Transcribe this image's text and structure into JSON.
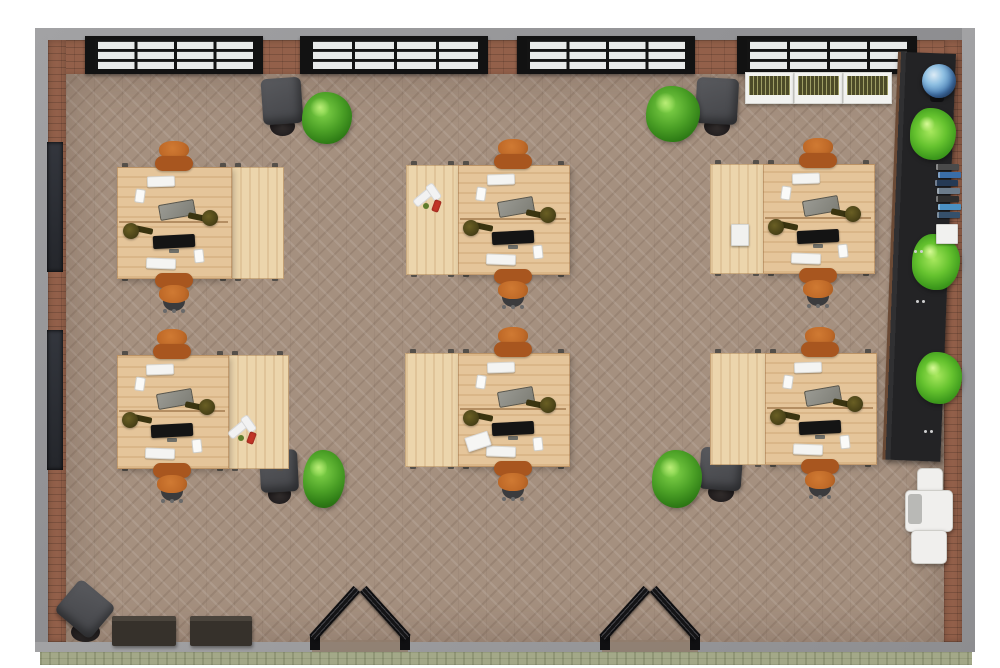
{
  "meta": {
    "description": "3D top-down floor plan render of an open-plan office with six 4-person desk clusters",
    "visible_text": []
  },
  "palette": {
    "background": "#ffffff",
    "wall_outer_grey": "#96969a",
    "brick_wall": "#93604a",
    "floor_taupe": "#a5907f",
    "window_frame_black": "#121212",
    "window_glass": "#e8eae9",
    "desk_wood": "#e5c59a",
    "desk_wood_light": "#ecd5ac",
    "chair_orange": "#c06a28",
    "chair_orange_dark": "#a8561f",
    "chair_dark_grey": "#4b4c4e",
    "plant_green": "#4ba026",
    "plant_lime": "#66c32f",
    "console_black": "#29292b",
    "lamp_olive": "#4c4418",
    "monitor_black": "#141414",
    "walkway_stone": "#a3a888",
    "planter_white": "#f2f2f0",
    "grass_olive": "#4c4a28",
    "globe_blue": "#4a7fb5",
    "cooler_white": "#f0efed",
    "bench_dark_brown": "#36312b",
    "door_black": "#1a1a1c"
  },
  "room": {
    "top_grey": [
      35,
      28,
      940,
      12
    ],
    "top_brick": [
      35,
      40,
      940,
      36
    ],
    "left_grey": [
      35,
      28,
      13,
      624
    ],
    "left_brick": [
      48,
      40,
      18,
      602
    ],
    "right_brick": [
      944,
      40,
      18,
      602
    ],
    "right_grey": [
      962,
      28,
      13,
      624
    ],
    "floor": [
      66,
      74,
      878,
      568
    ],
    "bottom_grey": [
      35,
      642,
      940,
      10
    ],
    "bottom_stone": [
      40,
      652,
      932,
      13
    ],
    "windows": [
      [
        85,
        36,
        178,
        38
      ],
      [
        300,
        36,
        188,
        38
      ],
      [
        517,
        36,
        178,
        38
      ],
      [
        737,
        36,
        180,
        38
      ]
    ],
    "window_grid": {
      "cols": 4,
      "rows": 3
    },
    "left_wall_panels": [
      [
        47,
        142,
        16,
        130
      ],
      [
        47,
        330,
        16,
        140
      ]
    ],
    "door_openings": [
      {
        "x1": 312,
        "x2": 408
      },
      {
        "x1": 602,
        "x2": 698
      }
    ]
  },
  "furniture": {
    "desk_clusters": [
      {
        "id": 1,
        "x": 117,
        "y": 167,
        "w": 165,
        "h": 110,
        "ext_side": "right",
        "ext_w": 52,
        "extras": []
      },
      {
        "id": 2,
        "x": 406,
        "y": 165,
        "w": 162,
        "h": 108,
        "ext_side": "left",
        "ext_w": 52,
        "extras": [
          {
            "type": "bottles",
            "cx": 434,
            "cy": 198
          }
        ]
      },
      {
        "id": 3,
        "x": 710,
        "y": 164,
        "w": 163,
        "h": 108,
        "ext_side": "left",
        "ext_w": 53,
        "extras": [
          {
            "type": "paper_box",
            "rect": [
              731,
              224,
              16,
              20
            ]
          }
        ]
      },
      {
        "id": 4,
        "x": 117,
        "y": 355,
        "w": 170,
        "h": 112,
        "ext_side": "right",
        "ext_w": 60,
        "extras": [
          {
            "type": "bottles",
            "cx": 249,
            "cy": 430
          }
        ]
      },
      {
        "id": 5,
        "x": 405,
        "y": 353,
        "w": 163,
        "h": 112,
        "ext_side": "left",
        "ext_w": 53,
        "extras": [
          {
            "type": "paper_sheet",
            "rect": [
              466,
              434,
              22,
              13
            ]
          }
        ]
      },
      {
        "id": 6,
        "x": 710,
        "y": 353,
        "w": 165,
        "h": 110,
        "ext_side": "left",
        "ext_w": 55,
        "extras": []
      }
    ],
    "lounge_chairs": [
      {
        "rect": [
          262,
          78,
          40,
          58
        ],
        "rot": -4
      },
      {
        "rect": [
          696,
          78,
          42,
          58
        ],
        "rot": 3
      },
      {
        "rect": [
          260,
          450,
          38,
          54
        ],
        "rot": -3
      },
      {
        "rect": [
          700,
          448,
          42,
          54
        ],
        "rot": 4
      },
      {
        "rect": [
          62,
          588,
          46,
          54
        ],
        "rot": 40
      }
    ],
    "bushes": [
      [
        302,
        92,
        50,
        52
      ],
      [
        646,
        86,
        54,
        56
      ],
      [
        303,
        450,
        42,
        58
      ],
      [
        652,
        450,
        50,
        58
      ]
    ],
    "planter_boxes": [
      [
        745,
        72,
        47,
        30
      ],
      [
        794,
        72,
        47,
        30
      ],
      [
        843,
        72,
        47,
        30
      ]
    ],
    "globe": {
      "stand": [
        930,
        76,
        14,
        26
      ],
      "sphere": [
        922,
        64,
        34,
        34
      ]
    },
    "console": {
      "rect": [
        898,
        54,
        58,
        408
      ],
      "palms": [
        [
          910,
          108,
          46,
          52
        ],
        [
          912,
          234,
          48,
          56
        ],
        [
          916,
          352,
          46,
          52
        ]
      ],
      "books": {
        "x": 936,
        "y": 164,
        "w": 21,
        "step": 8,
        "colors": [
          "#4a4a4a",
          "#3a6ea8",
          "#253a55",
          "#6b7b8a",
          "#2e2e2e",
          "#4a90c2",
          "#35506b"
        ]
      },
      "white_box": [
        936,
        224,
        20,
        18
      ],
      "handle_dots": [
        [
          914,
          250
        ],
        [
          916,
          300
        ],
        [
          924,
          430
        ]
      ]
    },
    "water_cooler": {
      "top": [
        917,
        468,
        24,
        24
      ],
      "body": [
        905,
        490,
        46,
        40
      ],
      "grey_panel": [
        908,
        494,
        14,
        30
      ],
      "tray": [
        911,
        530,
        34,
        32
      ]
    },
    "benches": [
      [
        112,
        616,
        64,
        30
      ],
      [
        190,
        616,
        62,
        30
      ]
    ]
  }
}
